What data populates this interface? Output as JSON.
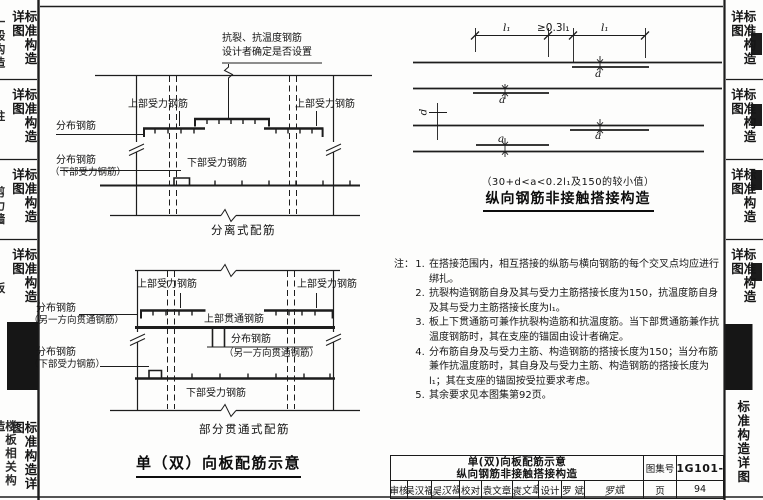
{
  "sidebar_left": {
    "tab_label": "标准构造详图",
    "groups": [
      {
        "partial": "一般构造"
      },
      {
        "partial": "柱"
      },
      {
        "partial": "剪力墙"
      },
      {
        "partial": "板"
      },
      {
        "partial": "楼板相关构造"
      }
    ]
  },
  "sidebar_right": {
    "tab_label": "标准构造详图"
  },
  "diagram_separated": {
    "note_line1": "抗裂、抗温度钢筋",
    "note_line2": "设计者确定是否设置",
    "label_top_bar_left": "上部受力钢筋",
    "label_top_bar_right": "上部受力钢筋",
    "label_dist_top": "分布钢筋",
    "label_dist_bottom_1": "分布钢筋",
    "label_dist_bottom_2": "（下部受力钢筋）",
    "label_bottom_bar": "下部受力钢筋",
    "caption": "分离式配筋"
  },
  "diagram_partial": {
    "label_top_bar_left": "上部受力钢筋",
    "label_top_bar_right": "上部受力钢筋",
    "label_dist_through_1": "分布钢筋",
    "label_dist_through_2": "（另一方向贯通钢筋）",
    "label_top_through": "上部贯通钢筋",
    "label_dist_mid_1": "分布钢筋",
    "label_dist_mid_2": "（另一方向贯通钢筋）",
    "label_dist_lower_1": "分布钢筋",
    "label_dist_lower_2": "（下部受力钢筋）",
    "label_bottom_bar": "下部受力钢筋",
    "caption": "部分贯通式配筋"
  },
  "left_title": "单（双）向板配筋示意",
  "diagram_lap": {
    "dim_l1_left": "l₁",
    "dim_mid": "≥0.3l₁",
    "dim_l1_right": "l₁",
    "label_a": "a",
    "label_d": "d",
    "formula": "（30+d<a<0.2l₁及150的较小值）",
    "title": "纵向钢筋非接触搭接构造"
  },
  "notes": {
    "prefix": "注：",
    "items": [
      "在搭接范围内，相互搭接的纵筋与横向钢筋的每个交叉点均应进行绑扎。",
      "抗裂构造钢筋自身及其与受力主筋搭接长度为150，抗温度筋自身及其与受力主筋搭接长度为l₁。",
      "板上下贯通筋可兼作抗裂构造筋和抗温度筋。当下部贯通筋兼作抗温度钢筋时，其在支座的锚固由设计者确定。",
      "分布筋自身及与受力主筋、构造钢筋的搭接长度为150；当分布筋兼作抗温度筋时，其自身及与受力主筋、构造钢筋的搭接长度为 l₁；其在支座的锚固按受拉要求考虑。",
      "其余要求见本图集第92页。"
    ]
  },
  "titleblock": {
    "title_line1": "单(双)向板配筋示意",
    "title_line2": "纵向钢筋非接触搭接构造",
    "atlas_label": "图集号",
    "atlas_no": "11G101-1",
    "page_label": "页",
    "page_no": "94",
    "review_label": "审核",
    "review_name": "吴汉福",
    "review_sig": "吴汉福",
    "check_label": "校对",
    "check_name": "袁文章",
    "check_sig": "袁文章",
    "design_label": "设计",
    "design_name": "罗 斌",
    "design_sig": "罗斌"
  }
}
